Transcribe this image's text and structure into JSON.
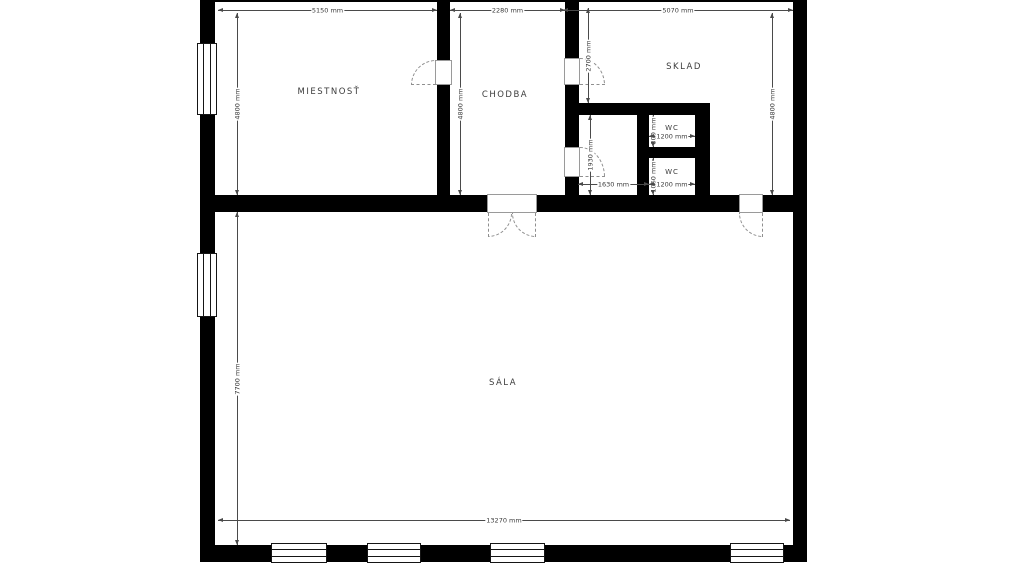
{
  "plan": {
    "rooms": [
      {
        "id": "miestnost",
        "label": "MIESTNOSŤ"
      },
      {
        "id": "chodba",
        "label": "CHODBA"
      },
      {
        "id": "sklad",
        "label": "SKLAD"
      },
      {
        "id": "wc-top",
        "label": "WC"
      },
      {
        "id": "wc-bottom",
        "label": "WC"
      },
      {
        "id": "sala",
        "label": "SÁLA"
      }
    ],
    "dims": {
      "top_left": "5150 mm",
      "top_mid": "2280 mm",
      "top_right": "5070 mm",
      "miestnost_h": "4800 mm",
      "chodba_h": "4800 mm",
      "corridor_h": "2700 mm",
      "sklad_h": "4800 mm",
      "hall_h": "1930 mm",
      "wc_top_h": "800 mm",
      "wc_top_w": "1200 mm",
      "wc_bot_h": "1060 mm",
      "wc_bot_w": "1200 mm",
      "hall_w": "1630 mm",
      "sala_h": "7700 mm",
      "bottom_w": "13270 mm"
    },
    "colors": {
      "wall": "#000000",
      "dimension_line": "#4a4a4a",
      "text": "#3b3b3b",
      "door_swing": "#8f8f8f",
      "background": "#ffffff"
    }
  }
}
